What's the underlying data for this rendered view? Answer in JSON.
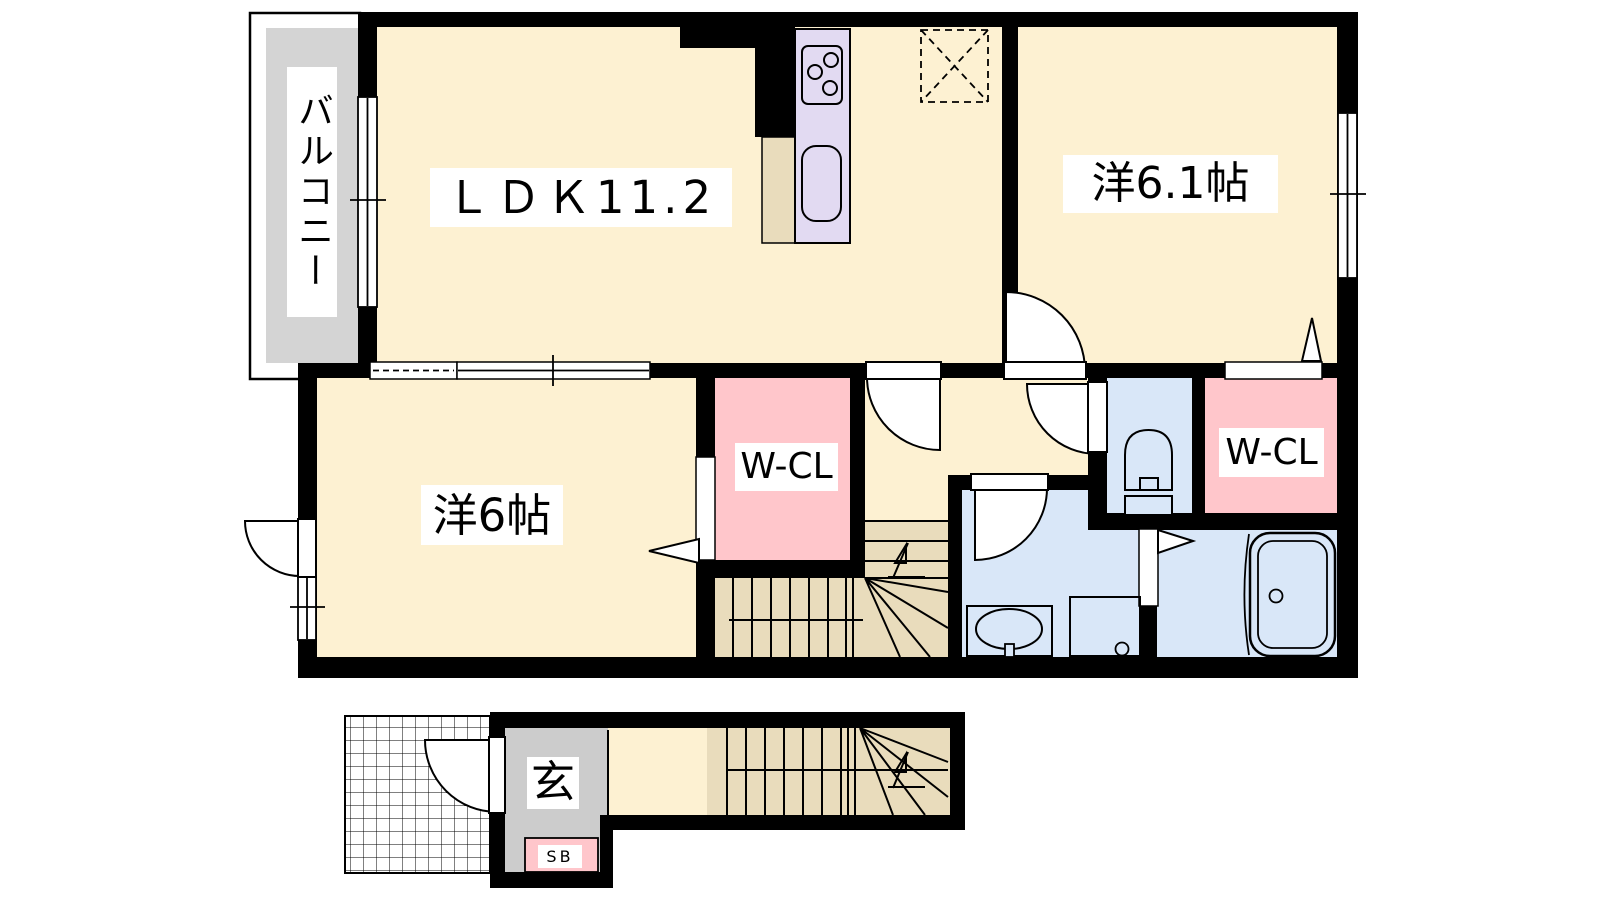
{
  "floor_plan": {
    "rooms": {
      "balcony": {
        "label": "バルコニー"
      },
      "ldk": {
        "label": "ＬＤＫ11.2"
      },
      "western_room_6_1": {
        "label": "洋6.1帖"
      },
      "western_room_6": {
        "label": "洋6帖"
      },
      "walk_in_closet_1": {
        "label": "W-CL"
      },
      "walk_in_closet_2": {
        "label": "W-CL"
      },
      "entrance": {
        "label": "玄"
      },
      "shoe_box": {
        "label": "SB"
      }
    },
    "colors": {
      "room_floor_cream": "#fdf1d2",
      "stairs_tan": "#e9dcbc",
      "closet_pink": "#ffc6cb",
      "water_blue": "#d9e7f8",
      "kitchen_lavender": "#e2daf2",
      "balcony_gray": "#d4d4d4",
      "entrance_gray": "#cccccc",
      "wall": "#000000",
      "background": "#ffffff"
    }
  }
}
